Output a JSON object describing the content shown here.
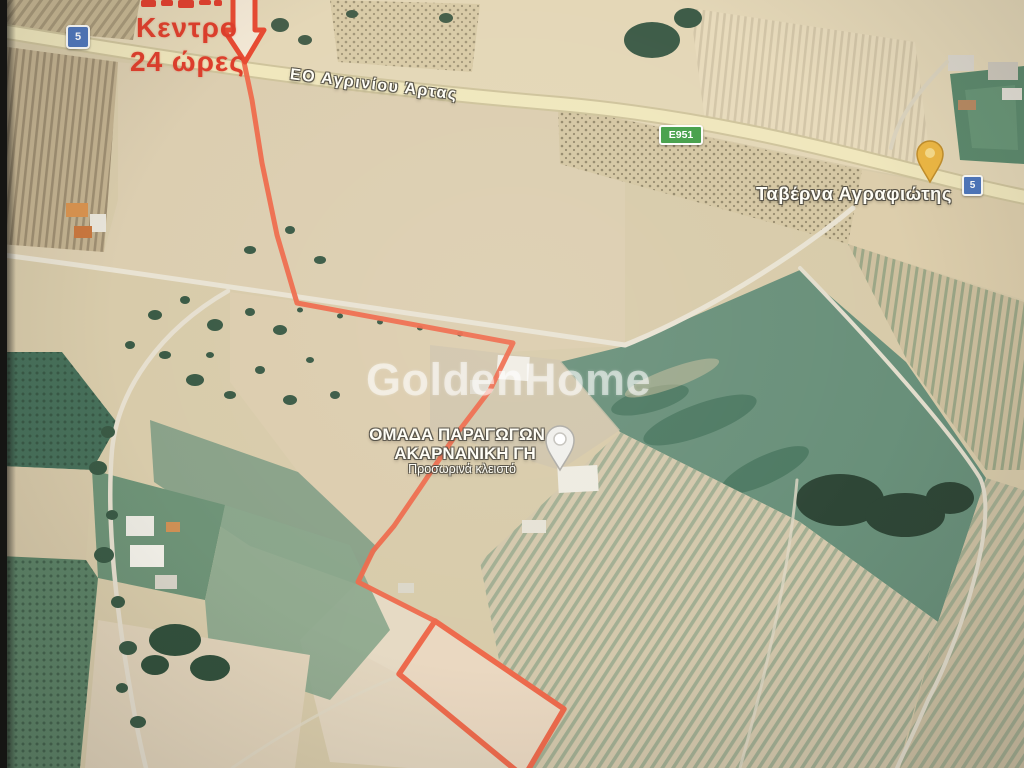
{
  "watermark": "GoldenHome",
  "annotation": {
    "line1": "Κεντρο",
    "line2": "24 ώρες",
    "color": "#df3f2c"
  },
  "roads": {
    "main_label": "ΕΟ Αγρινίου Άρτας",
    "shield_left": "5",
    "shield_right": "5",
    "shield_european": "E951"
  },
  "pois": {
    "tavern": {
      "label": "Ταβέρνα Αγραφιώτης",
      "pin_color": "#eeb844"
    },
    "producers": {
      "line1": "ΟΜΑΔΑ ΠΑΡΑΓΩΓΩΝ",
      "line2": "ΑΚΑΡΝΑΝΙΚΗ ΓΗ",
      "status": "Προσωρινά κλειστό",
      "pin_color": "#f0efeb"
    }
  },
  "route": {
    "color": "#ee6a4c"
  },
  "colors": {
    "highway_fill": "#f0e7bd",
    "shield_blue": "#4f77bc",
    "shield_green": "#47a04b"
  }
}
